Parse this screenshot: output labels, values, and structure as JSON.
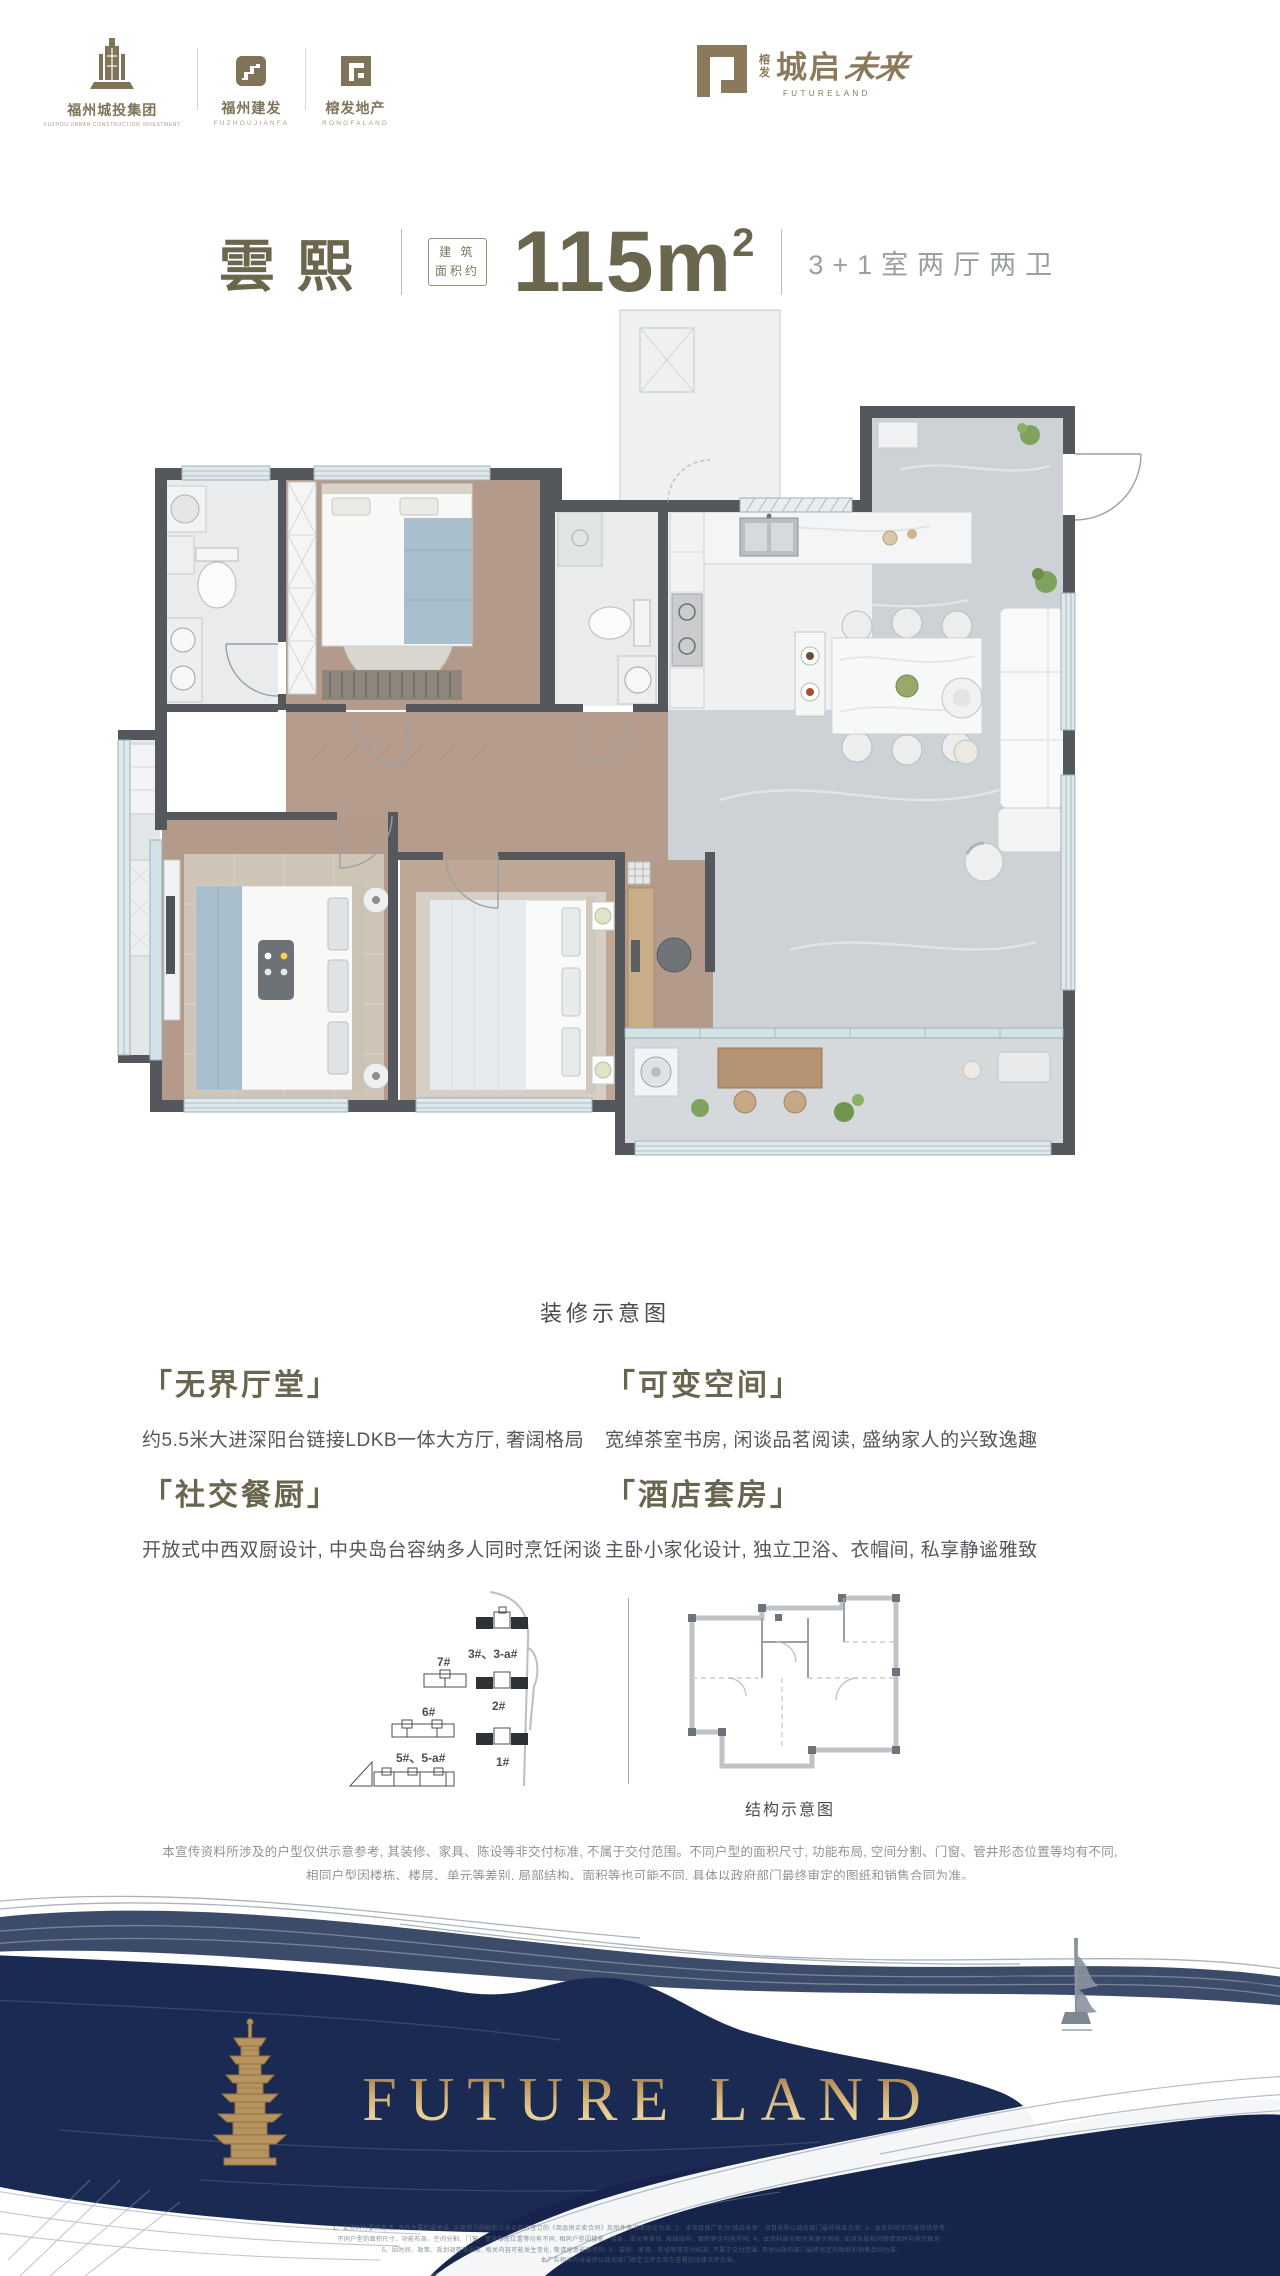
{
  "header": {
    "logos_left": [
      {
        "name": "福州城投集团",
        "sub": "FUZHOU URBAN CONSTRUCTION INVESTMENT"
      },
      {
        "name": "福州建发",
        "sub": "FUZHOUJIANFA"
      },
      {
        "name": "榕发地产",
        "sub": "RONGFALAND"
      }
    ],
    "logo_right": {
      "prefix_top": "榕",
      "prefix_bottom": "发",
      "main": "城启",
      "stylized": "未来",
      "en": "FUTURELAND"
    }
  },
  "title": {
    "name": "雲熙",
    "area_tag_top": "建 筑",
    "area_tag_bottom": "面积约",
    "area_value": "115m",
    "area_exp": "2",
    "layout": "3+1室两厅两卫"
  },
  "floorplan": {
    "caption": "装修示意图"
  },
  "features": [
    {
      "title": "「无界厅堂」",
      "desc": "约5.5米大进深阳台链接LDKB一体大方厅, 奢阔格局"
    },
    {
      "title": "「社交餐厨」",
      "desc": "开放式中西双厨设计, 中央岛台容纳多人同时烹饪闲谈"
    },
    {
      "title": "「可变空间」",
      "desc": "宽绰茶室书房, 闲谈品茗阅读, 盛纳家人的兴致逸趣"
    },
    {
      "title": "「酒店套房」",
      "desc": "主卧小家化设计, 独立卫浴、衣帽间, 私享静谧雅致"
    }
  ],
  "site_diagram": {
    "labels": {
      "b3": "3#、3-a#",
      "b7": "7#",
      "b2": "2#",
      "b6": "6#",
      "b1": "1#",
      "b5": "5#、5-a#"
    }
  },
  "structure_diagram": {
    "caption": "结构示意图"
  },
  "disclaimer": {
    "line1": "本宣传资料所涉及的户型仅供示意参考, 其装修、家具、陈设等非交付标准, 不属于交付范围。不同户型的面积尺寸, 功能布局, 空间分割、门窗、管井形态位置等均有不同,",
    "line2": "相同户型因楼栋、楼层、单元等差别, 局部结构、面积等也可能不同, 具体以政府部门最终审定的图纸和销售合同为准。"
  },
  "footer": {
    "brand": "FUTURE LAND",
    "fine_print": [
      "1、本资料为要约邀请, 不作为要约或承诺, 买卖双方的权利义务以双方签订的《商品房买卖合同》及附件等书面协议为准; 2、本项目推广名为“城启未来”, 项目名称以政府部门最终核准为准; 3、本资料所示内容仅供参考,",
      "不同户型的面积尺寸、功能布局、空间分割、门窗、管井形态位置等均有不同, 相同户型因楼栋、楼层、单元等差别, 局部结构、面积等也可能不同; 4、本资料部分图片来源于网络, 如涉及版权问题请及时与我司联系;",
      "5、因时间、政策、规划调整等因素, 相关内容可能发生变化, 敬请留意最新资料; 6、装修、家具、陈设等非交付标准, 不属于交付范围, 具体以政府部门最终审定的图纸和销售合同为准;",
      "本广告相关内容最终以政府部门审定文件及双方签署的法律文件为准。"
    ]
  },
  "colors": {
    "brand_brown": "#7f7459",
    "title_olive": "#6b664e",
    "muted_gray": "#9aa09c",
    "navy": "#1b2a52",
    "gold": "#c2a061"
  }
}
